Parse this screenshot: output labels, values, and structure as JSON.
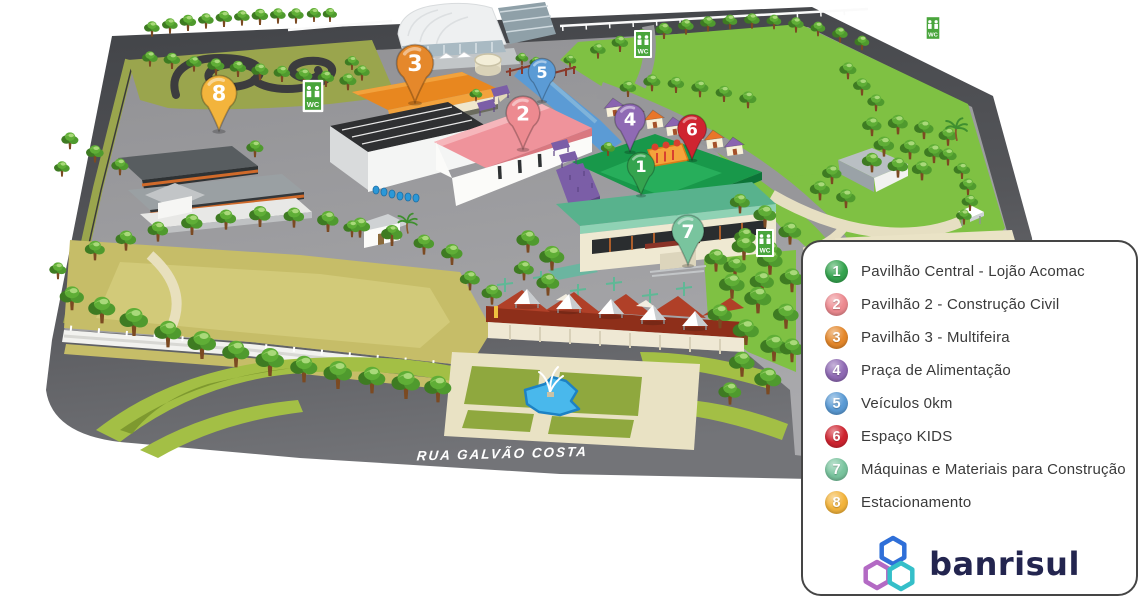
{
  "map": {
    "road_label": "RUA GALVÃO COSTA",
    "wc_label": "WC",
    "places": [
      {
        "number": "1",
        "label": "Pavilhão Central - Lojão Acomac",
        "color": "#35a44f",
        "x": 641,
        "y": 166,
        "scale": 0.85
      },
      {
        "number": "2",
        "label": "Pavilhão 2 - Construção Civil",
        "color": "#ed8a90",
        "x": 523,
        "y": 113,
        "scale": 1.05
      },
      {
        "number": "3",
        "label": "Pavilhão 3 - Multifeira",
        "color": "#e5882b",
        "x": 415,
        "y": 63,
        "scale": 1.15
      },
      {
        "number": "4",
        "label": "Praça de Alimentação",
        "color": "#8f6ab4",
        "x": 630,
        "y": 119,
        "scale": 0.95
      },
      {
        "number": "5",
        "label": "Veículos 0km",
        "color": "#5b9bd5",
        "x": 542,
        "y": 72,
        "scale": 0.85
      },
      {
        "number": "6",
        "label": "Espaço KIDS",
        "color": "#cf2430",
        "x": 692,
        "y": 129,
        "scale": 0.9
      },
      {
        "number": "7",
        "label": "Máquinas e Materiais para Construção",
        "color": "#79c49e",
        "x": 688,
        "y": 231,
        "scale": 1.0
      },
      {
        "number": "8",
        "label": "Estacionamento",
        "color": "#f3b43c",
        "x": 219,
        "y": 93,
        "scale": 1.1
      }
    ]
  },
  "legend": {
    "logo_text": "banrisul"
  }
}
